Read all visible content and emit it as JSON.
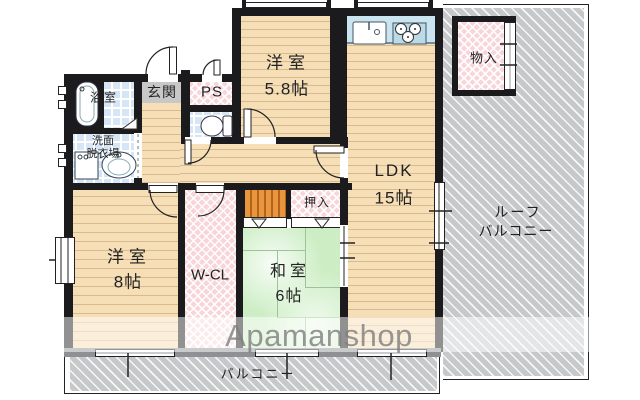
{
  "watermark": {
    "text": "Apamanshop"
  },
  "rooms": {
    "bath": {
      "label": "浴室"
    },
    "genkan": {
      "label": "玄関"
    },
    "ps": {
      "label": "PS"
    },
    "washroom": {
      "line1": "洗面",
      "line2": "脱衣場"
    },
    "western_58": {
      "label": "洋室",
      "size": "5.8帖"
    },
    "ldk": {
      "label": "LDK",
      "size": "15帖"
    },
    "storage": {
      "label": "物入"
    },
    "roof_balcony": {
      "line1": "ルーフ",
      "line2": "バルコニー"
    },
    "western_8": {
      "label": "洋室",
      "size": "8帖"
    },
    "wcl": {
      "label": "W-CL"
    },
    "washitsu": {
      "label": "和室",
      "size": "6帖"
    },
    "oshiire": {
      "label": "押入"
    },
    "balcony": {
      "label": "バルコニー"
    }
  },
  "colors": {
    "wall": "#1B1B1D",
    "wood_floor": "#F6DEB7",
    "tile": "#D6E6F6",
    "closet_pink": "#F8D5D9",
    "tatami_green": "#CDEEC5",
    "balcony_gray": "#C6C8CA",
    "entry_gray": "#C8C8C8",
    "closet_orange": "#E9953E",
    "watermark_gray": "#7F7F7F"
  }
}
